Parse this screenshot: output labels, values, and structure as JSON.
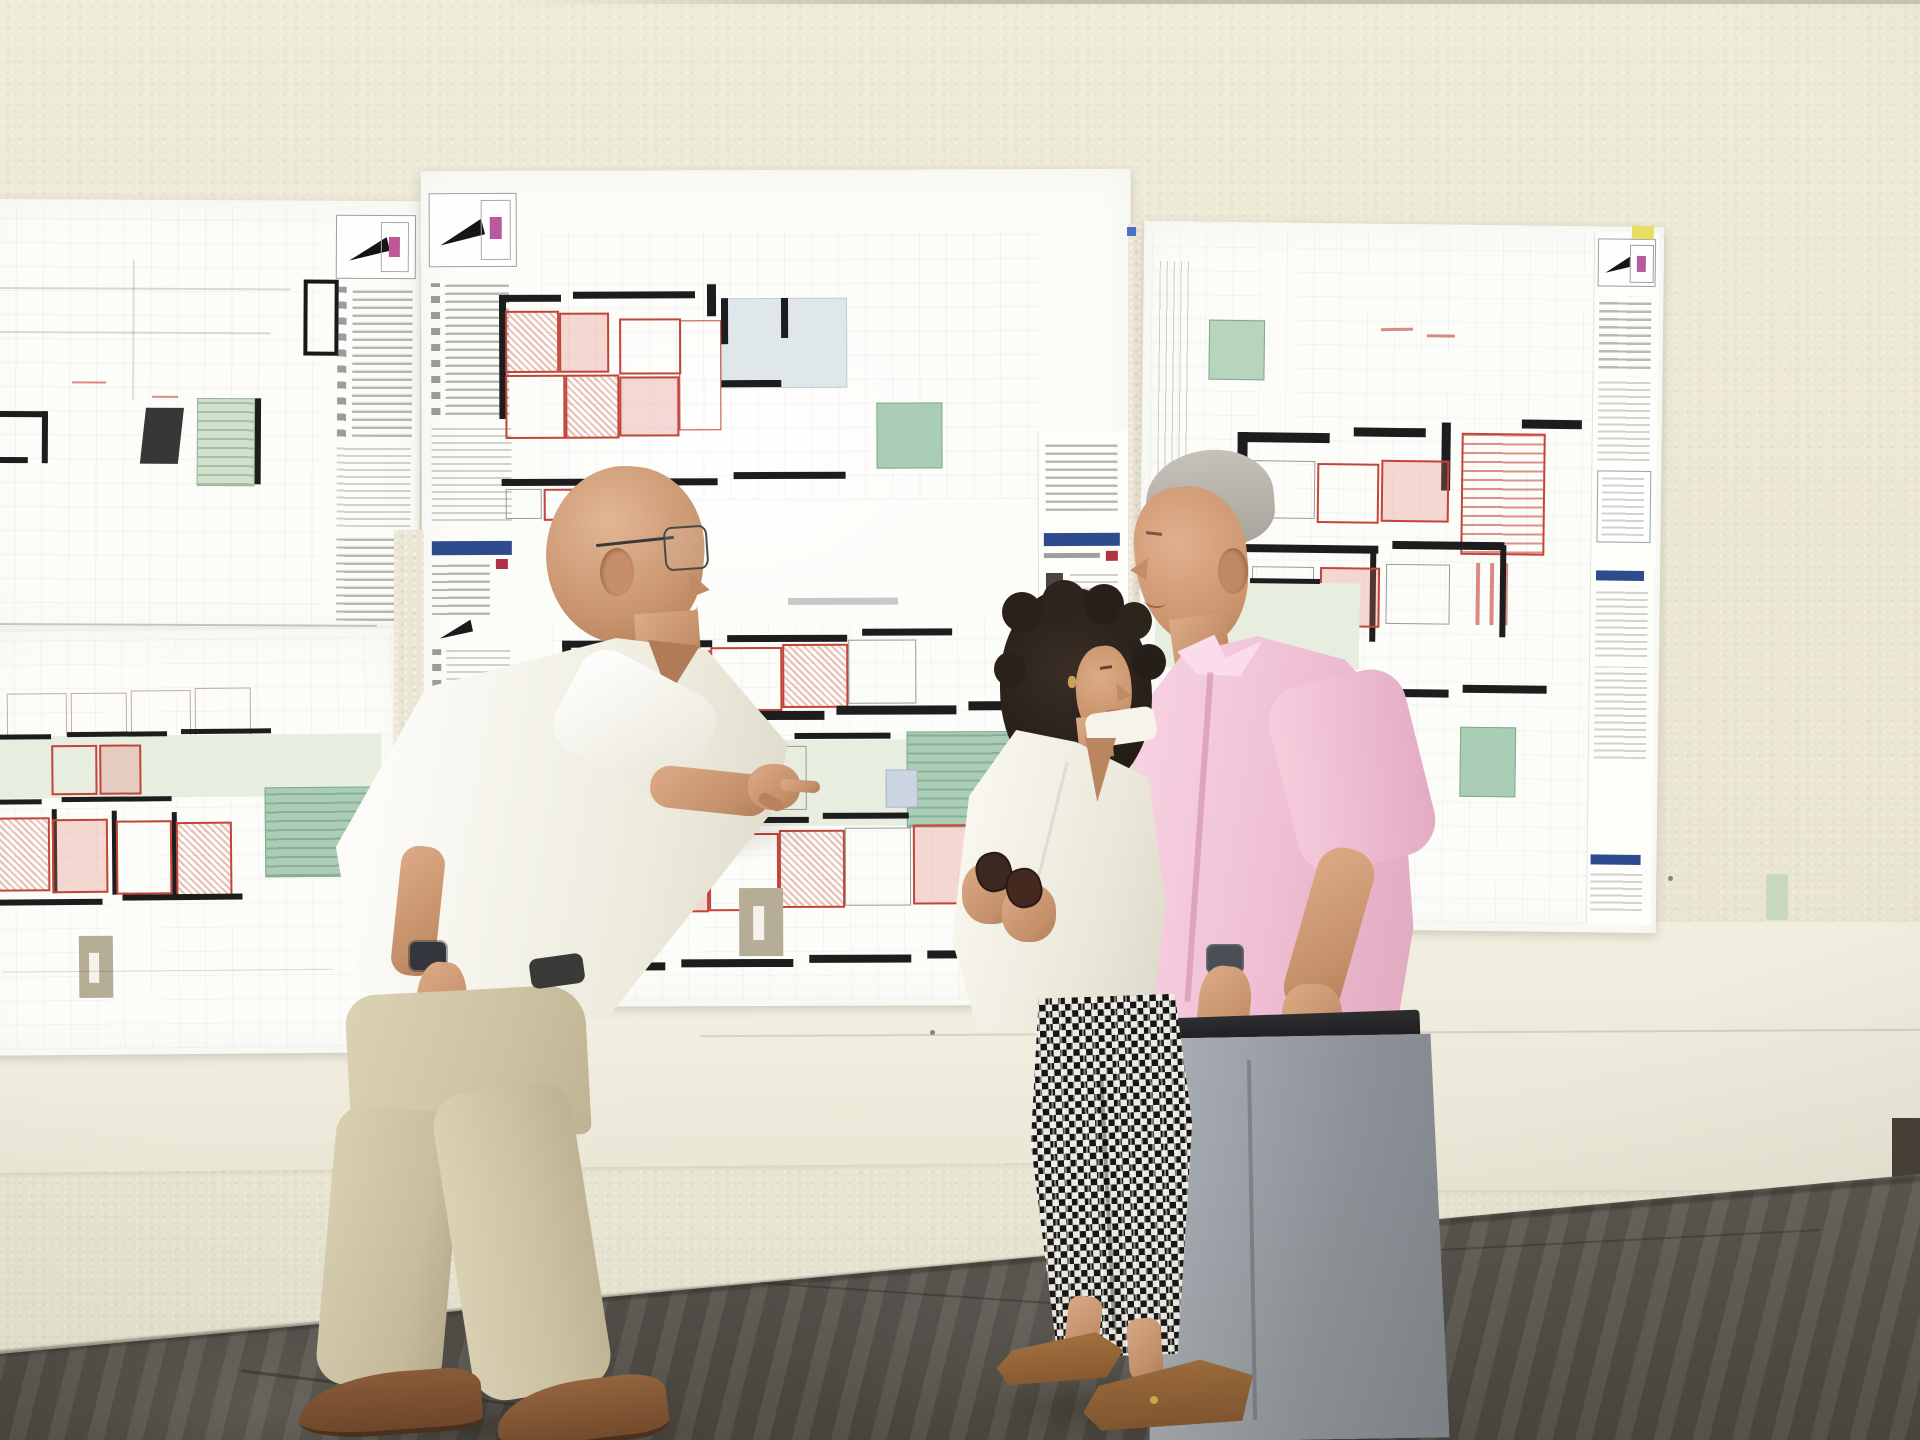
{
  "scene": {
    "description": "Photograph: three people review large architectural floor-plan sheets taped to a textured cream wall above a smooth panel band; dark mottled stone floor below.",
    "setting": "building interior with blueprint sheets pinned on wall",
    "people": [
      {
        "id": "architect",
        "description": "Older bald man with glasses, white short-sleeved shirt, beige trousers and brown shoes, pointing with his right hand at the middle floor plan",
        "accessories": [
          "wire glasses",
          "dark wristwatch"
        ]
      },
      {
        "id": "woman",
        "description": "Woman with dark curly hair, cream blazer, black-and-white checked cropped trousers and brown pointed flats, holding dark sunglasses in her hands",
        "accessories": [
          "sunglasses",
          "gold earring"
        ]
      },
      {
        "id": "man-pink",
        "description": "Man with short gray hair in a pink short-sleeved shirt, dark belt and gray trousers, wristwatch on left arm",
        "accessories": [
          "wristwatch"
        ]
      }
    ],
    "sheets": [
      {
        "id": "sheet-top-left",
        "description": "Plan sheet with legend column, black room outline, dark door block and green stair core"
      },
      {
        "id": "sheet-bottom-left",
        "description": "Plan sheet with pale green corridor, sea-green stair block, red hatched rooms and tan stair"
      },
      {
        "id": "sheet-middle",
        "description": "Large plan sheet with two stacked floor plans, red marked rooms, blue-gray hall, green corridor, title/legend columns on both edges with blue header bars"
      },
      {
        "id": "sheet-top-right",
        "description": "Plan sheet with red stair hatching, green rooms, dimension strip and right-hand title column"
      }
    ],
    "wall": {
      "upper": "textured cream stucco",
      "band": "smooth off-white panel band with seam",
      "floor": "dark gray-brown mottled stone"
    }
  },
  "palette": {
    "wall": "#eae6d3",
    "band": "#f1eee0",
    "floor_dark": "#57534b",
    "floor_light": "#6e6a61",
    "sheet_paper": "#fcfcf9",
    "plan_wall": "#1d1d1d",
    "plan_red": "#c2453a",
    "plan_pink_fill": "#e8a49b",
    "plan_green_light": "#e7eedf",
    "plan_green": "#a9cdb5",
    "plan_bluegray": "#dfe7ea",
    "plan_tan": "#b6ad96",
    "title_blue": "#2e4b8e",
    "skin": "#d29d7b",
    "shirt_white": "#f4f2e9",
    "blazer_cream": "#f2efe4",
    "shirt_pink": "#f2c6da",
    "trousers_beige": "#d2c8a9",
    "trousers_gray": "#979ca2",
    "pants_check_dark": "#161616",
    "shoes_brown": "#8a5a36",
    "hair_dark": "#2b231e",
    "hair_gray": "#b5b1a8",
    "sunglasses": "#3a2722",
    "watch_dark": "#34383e",
    "sticky_yellow": "#e6df63"
  }
}
